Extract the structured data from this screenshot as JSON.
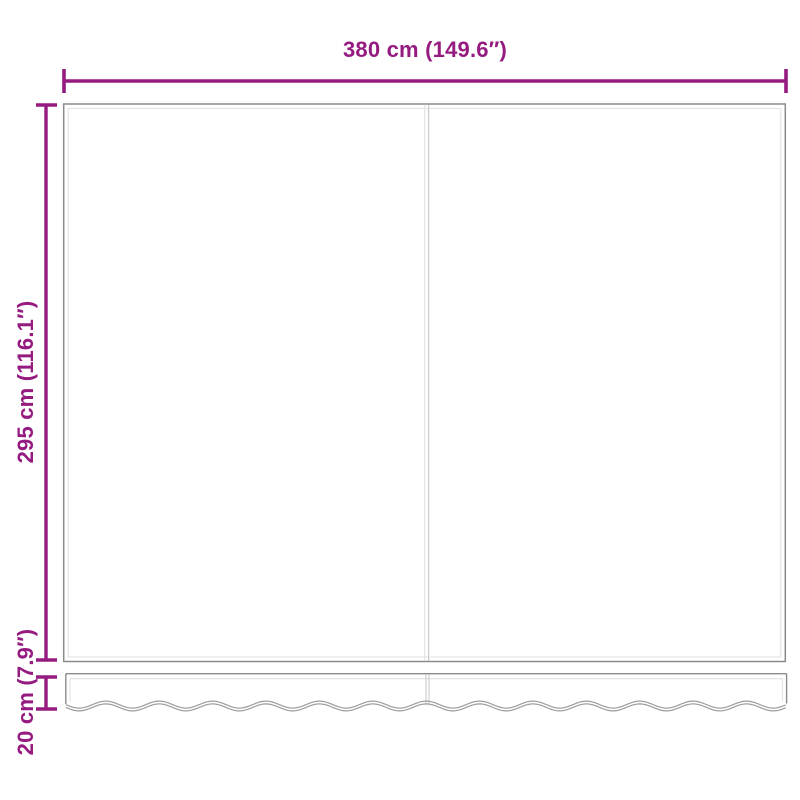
{
  "colors": {
    "accent": "#951b81",
    "panel_outline": "#8b8b8b",
    "panel_inner_line": "#e4e4e4",
    "seam_light": "#e2e2e2",
    "seam_dark": "#cbcbcb",
    "valance_outline": "#9c9c9c"
  },
  "diagram": {
    "width_label": "380 cm (149.6″)",
    "height_label": "295 cm (116.1″)",
    "valance_label": "20 cm (7.9″)"
  }
}
